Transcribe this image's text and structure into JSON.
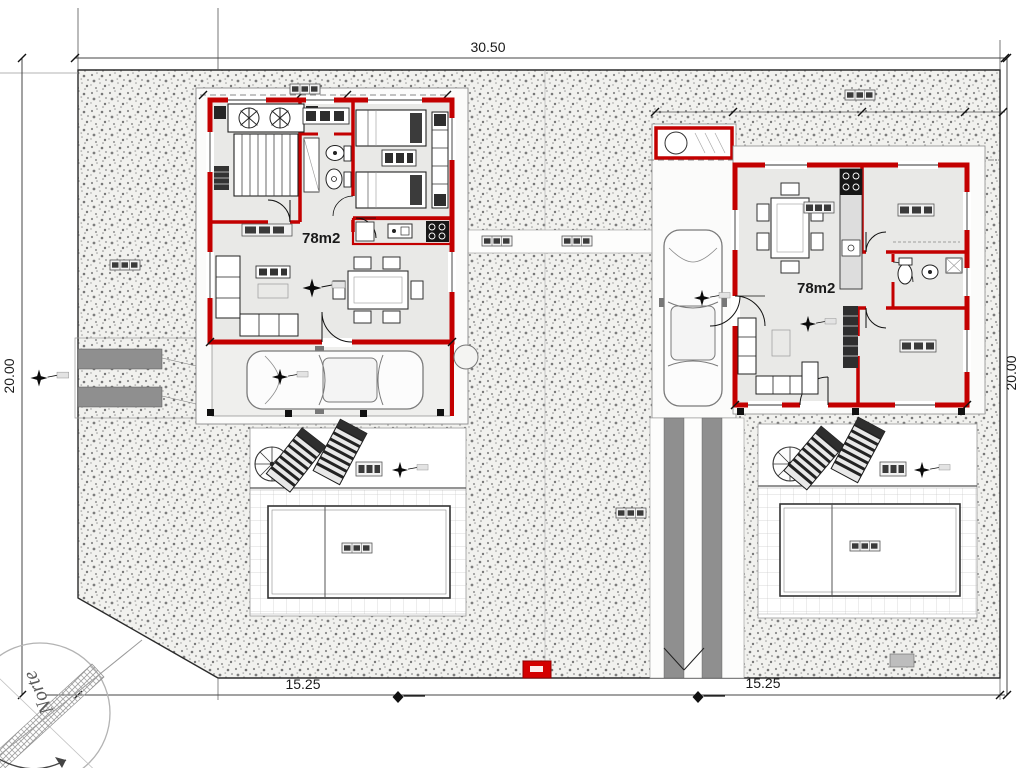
{
  "title": "Site plan - two mirrored 78m2 houses with pools",
  "dims": {
    "plot_width": "30.50",
    "plot_depth_left": "20.00",
    "plot_depth_right": "20.00",
    "lot_left_width": "15.25",
    "lot_right_width": "15.25"
  },
  "houses": {
    "left_area": "78m2",
    "right_area": "78m2"
  },
  "compass": {
    "north_label": "Norte"
  },
  "colors": {
    "wall_red": "#c30000",
    "floor_gray": "#e9e9e7",
    "ground_speckle": "#7a7a7a",
    "driveway_gray": "#8f8f8f",
    "gate_red": "#d40000"
  }
}
